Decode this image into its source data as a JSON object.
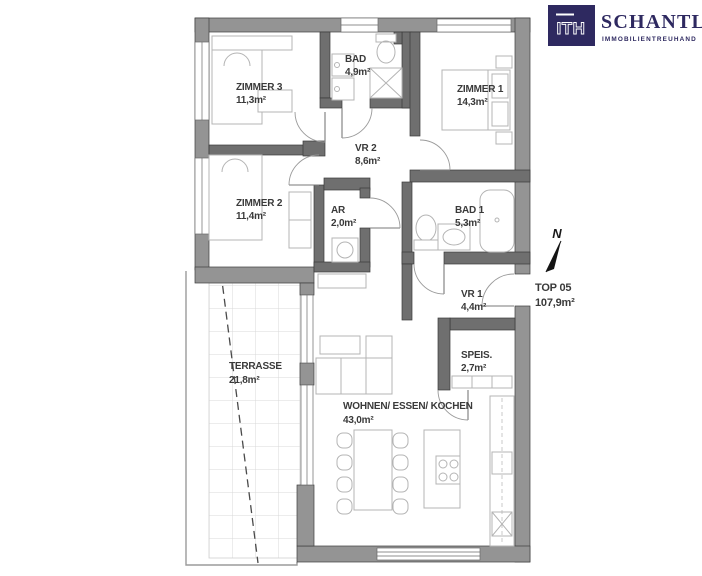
{
  "brand": {
    "logo_mark": "ITH",
    "logo_name": "SCHANTL",
    "logo_subtitle": "IMMOBILIENTREUHAND",
    "color": "#2e2960"
  },
  "plan": {
    "unit": {
      "label": "TOP 05",
      "area": "107,9m²"
    },
    "north": {
      "label": "N"
    },
    "rooms": {
      "zimmer3": {
        "label": "ZIMMER 3",
        "area": "11,3m²"
      },
      "bad": {
        "label": "BAD",
        "area": "4,9m²"
      },
      "zimmer1": {
        "label": "ZIMMER 1",
        "area": "14,3m²"
      },
      "vr2": {
        "label": "VR 2",
        "area": "8,6m²"
      },
      "zimmer2": {
        "label": "ZIMMER 2",
        "area": "11,4m²"
      },
      "ar": {
        "label": "AR",
        "area": "2,0m²"
      },
      "bad1": {
        "label": "BAD 1",
        "area": "5,3m²"
      },
      "vr1": {
        "label": "VR 1",
        "area": "4,4m²"
      },
      "speis": {
        "label": "SPEIS.",
        "area": "2,7m²"
      },
      "wohnen": {
        "label": "WOHNEN/ ESSEN/ KOCHEN",
        "area": "43,0m²"
      },
      "terrasse": {
        "label": "TERRASSE",
        "area": "21,8m²"
      }
    }
  },
  "colors": {
    "wall_exterior": "#949494",
    "wall_interior": "#6f6f6f",
    "label_text": "#3a3a3a"
  }
}
